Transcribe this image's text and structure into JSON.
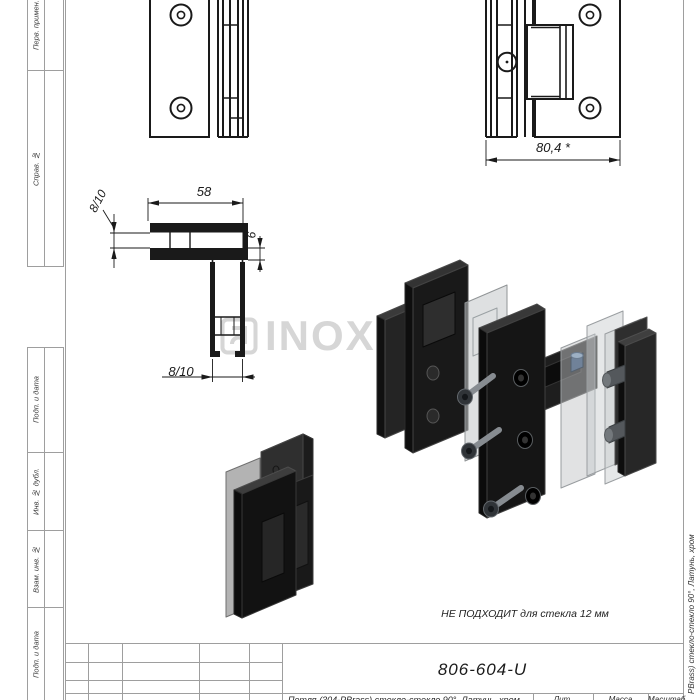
{
  "frame": {
    "margin_labels": [
      "Перв. примен.",
      "Справ. №",
      "Подп. и дата",
      "Инв. № дубл.",
      "Взам. инв. №",
      "Подп. и дата"
    ],
    "side_text": "PBrass) стекло-стекло 90°, Латунь, хром"
  },
  "drawing": {
    "dims": {
      "overall_width": "80,4 *",
      "arm_length": "58",
      "glass_left": "8/10",
      "plate_thickness": "6",
      "glass_bottom": "8/10"
    },
    "note": "НЕ ПОДХОДИТ для стекла 12 мм"
  },
  "watermark": {
    "text": "INOXHUB",
    "color": "#d6d6d6"
  },
  "title_block": {
    "designation": "806-604-U",
    "name_row": "Петля (304-PBrass) стекло-стекло 90°, Латунь, хром",
    "headers": {
      "lit": "Лит.",
      "mass": "Масса",
      "scale": "Масштаб"
    }
  },
  "colors": {
    "line": "#1a1a1a",
    "frame_line": "#9e9e9e",
    "part_dark": "#1c1c1c",
    "gasket": "#c4c7c9"
  }
}
